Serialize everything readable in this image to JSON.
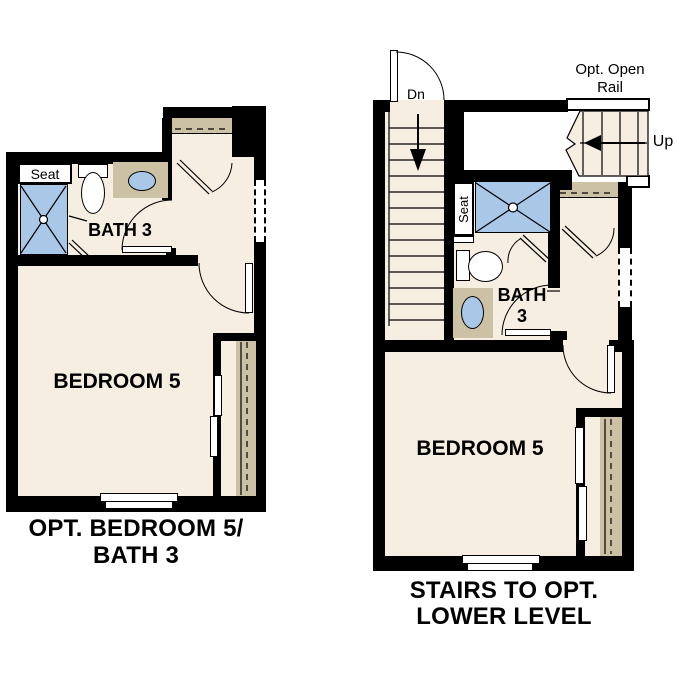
{
  "colors": {
    "wall": "#000000",
    "floor": "#f5eee1",
    "counter_tan": "#cdc1a5",
    "water_blue": "#a9c7e7",
    "text": "#000000",
    "background": "#ffffff"
  },
  "left_plan": {
    "labels": {
      "seat": "Seat",
      "bath": "BATH 3",
      "bedroom": "BEDROOM 5"
    },
    "caption_line1": "OPT. BEDROOM 5/",
    "caption_line2": "BATH 3"
  },
  "right_plan": {
    "labels": {
      "down": "Dn",
      "up": "Up",
      "open_rail_line1": "Opt. Open",
      "open_rail_line2": "Rail",
      "seat": "Seat",
      "bath_line1": "BATH",
      "bath_line2": "3",
      "bedroom": "BEDROOM 5"
    },
    "caption_line1": "STAIRS TO OPT.",
    "caption_line2": "LOWER LEVEL"
  }
}
